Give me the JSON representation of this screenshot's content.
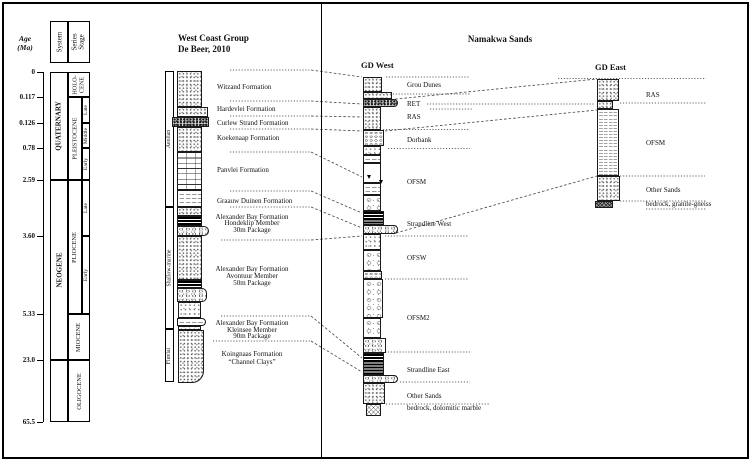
{
  "axis": {
    "age_line1": "Age",
    "age_line2": "(Ma)",
    "ticks": [
      "0",
      "0.117",
      "0.126",
      "0.78",
      "2.59",
      "3.60",
      "5.33",
      "23.0",
      "65.5"
    ],
    "header_system": "System",
    "header_series": "Series",
    "header_stage": "Stage",
    "quaternary": "QUATERNARY",
    "neogene": "NEOGENE",
    "holocene_line1": "HOLO-",
    "holocene_line2": "CENE",
    "pleistocene": "PLEISTOCENE",
    "pliocene": "PLIOCENE",
    "miocene": "MIOCENE",
    "oligocene": "OLIGOCENE",
    "stage_pleist_late": "Late",
    "stage_pleist_middle": "Middle",
    "stage_pleist_early": "Early",
    "stage_plio_late": "Late",
    "stage_plio_early": "Early"
  },
  "west_coast": {
    "title_line1": "West Coast Group",
    "title_line2": "De Beer, 2010",
    "environments": {
      "aeolian": "Aeolian",
      "shallow_marine": "Shallow-marine",
      "fluvial": "Fluvial"
    },
    "formations": {
      "witzand": "Witzand Formation",
      "hardevlei": "Hardevlei Formation",
      "curlew": "Curlew Strand Formation",
      "koekenaap": "Koekenaap Formation",
      "panvlei": "Panvlei Formation",
      "graauw": "Graauw Duinen Formation",
      "hondeklip": [
        "Alexander Bay Formation",
        "Hondeklip Member",
        "30m Package"
      ],
      "avontuur": [
        "Alexander Bay Formation",
        "Avontuur Member",
        "50m Package"
      ],
      "kleinsee": [
        "Alexander Bay Formation",
        "Kleinsee Member",
        "90m Package"
      ],
      "koingnaas": [
        "Koingnaas Formation",
        "“Channel Clays”"
      ]
    }
  },
  "namakwa": {
    "title": "Namakwa Sands",
    "gd_west": {
      "title": "GD West",
      "units": {
        "grou_dunes": "Grou Dunes",
        "ret": "RET",
        "ras": "RAS",
        "dorbank": "Dorbank",
        "ofsm": "OFSM",
        "strandline_west": "Strandline West",
        "ofsw": "OFSW",
        "ofsm2": "OFSM2",
        "strandline_east": "Strandline East",
        "other_sands": "Other Sands",
        "bedrock": "bedrock, dolomitic marble"
      }
    },
    "gd_east": {
      "title": "GD East",
      "units": {
        "ras": "RAS",
        "ofsm": "OFSM",
        "other_sands": "Other Sands",
        "bedrock": "bedrock, granite-gneiss"
      }
    }
  }
}
